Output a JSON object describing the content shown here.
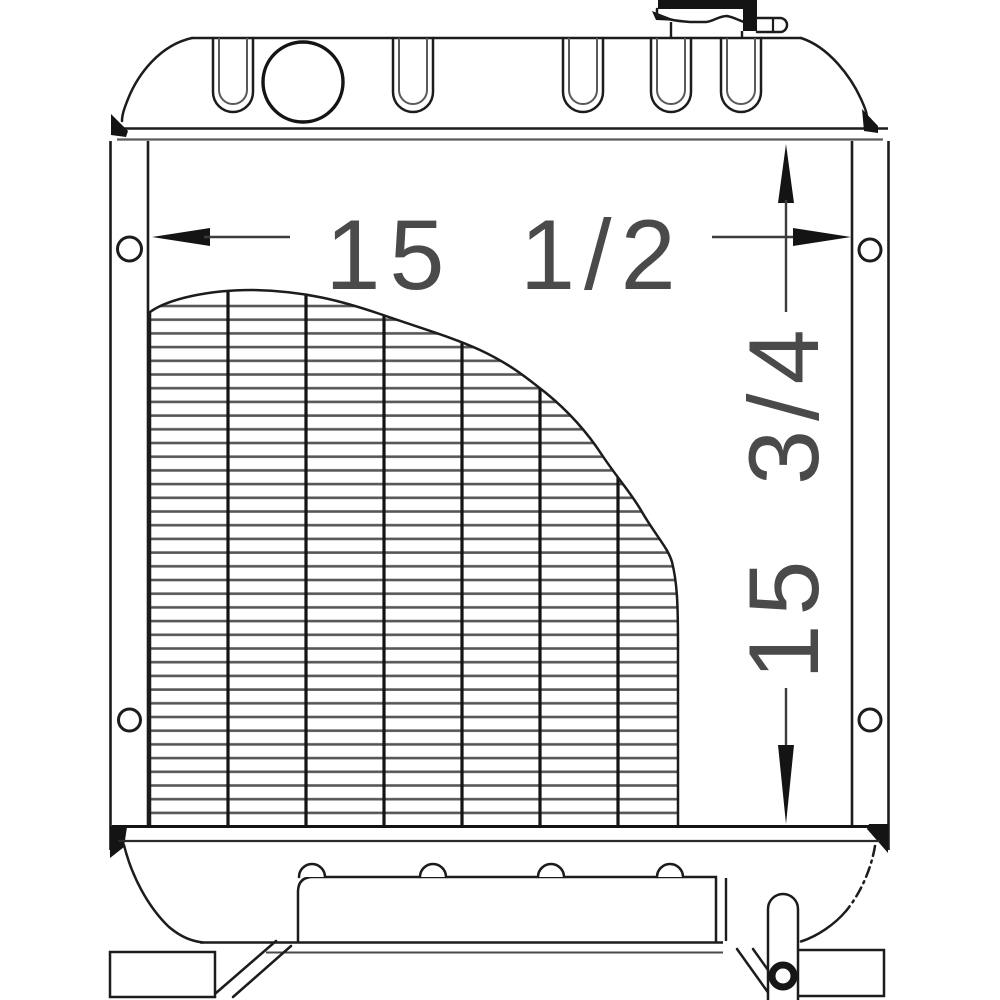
{
  "diagram": {
    "subject": "radiator-front-view-line-drawing",
    "colors": {
      "background": "#ffffff",
      "line": "#1c1c1c",
      "dimension_text": "#4a4a4a"
    },
    "annotations": {
      "width_dimension": "15 1/2",
      "height_dimension": "15 3/4"
    },
    "parts": [
      "radiator-cap",
      "overflow-pipe",
      "top-tank",
      "filler-opening",
      "mounting-slots",
      "left-side-channel",
      "right-side-channel",
      "mounting-holes",
      "radiator-core",
      "bottom-tank",
      "baffle-plate",
      "outlet-pipe",
      "mounting-feet"
    ]
  }
}
